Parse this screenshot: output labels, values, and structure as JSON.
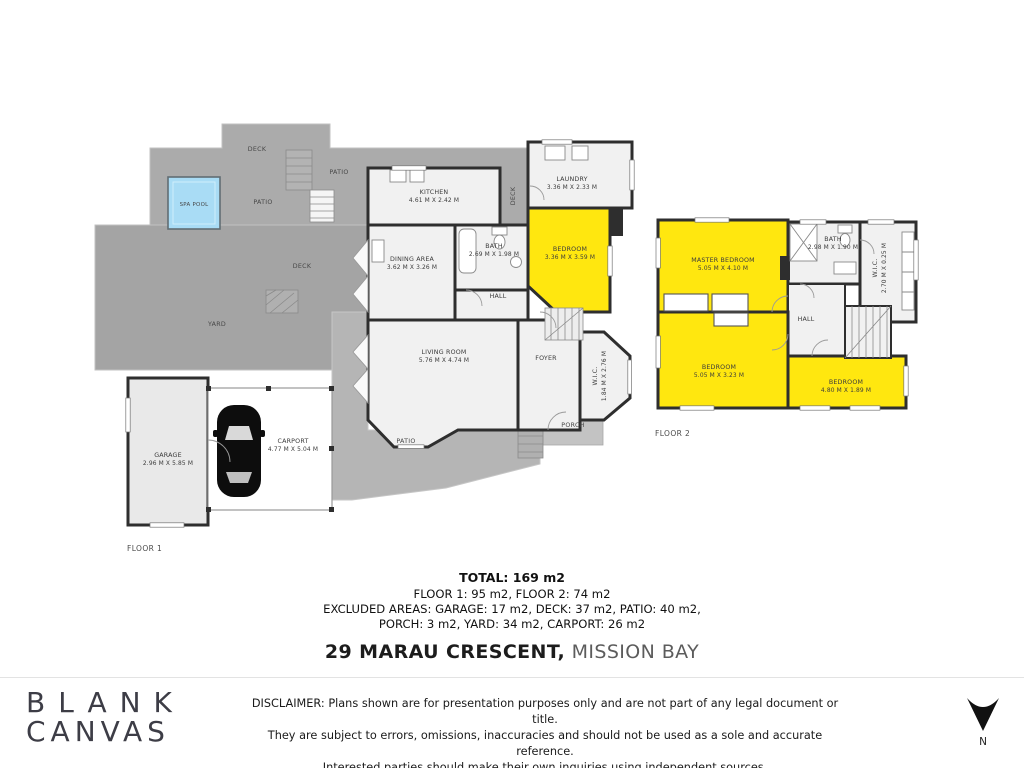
{
  "floor1": {
    "floor_label": "FLOOR 1",
    "outdoor": {
      "deck_top": "DECK",
      "patio_top": "PATIO",
      "spa_pool": "SPA POOL",
      "patio_mid": "PATIO",
      "deck_mid": "DECK",
      "yard": "YARD",
      "deck_strip": "DECK",
      "patio_bottom": "PATIO",
      "porch": "PORCH"
    },
    "rooms": {
      "kitchen": {
        "name": "KITCHEN",
        "dims": "4.61 M X 2.42 M"
      },
      "laundry": {
        "name": "LAUNDRY",
        "dims": "3.36 M X 2.33 M"
      },
      "bath": {
        "name": "BATH",
        "dims": "2.69 M X 1.98 M"
      },
      "bedroom": {
        "name": "BEDROOM",
        "dims": "3.36 M X 3.59 M"
      },
      "dining": {
        "name": "DINING AREA",
        "dims": "3.62 M X 3.26 M"
      },
      "living": {
        "name": "LIVING ROOM",
        "dims": "5.76 M X 4.74 M"
      },
      "hall": {
        "name": "HALL"
      },
      "foyer": {
        "name": "FOYER"
      },
      "wic": {
        "name": "W.I.C.",
        "dims": "1.84 M X 2.76 M"
      },
      "garage": {
        "name": "GARAGE",
        "dims": "2.96 M X 5.85 M"
      },
      "carport": {
        "name": "CARPORT",
        "dims": "4.77 M X 5.04 M"
      }
    }
  },
  "floor2": {
    "floor_label": "FLOOR 2",
    "rooms": {
      "master": {
        "name": "MASTER BEDROOM",
        "dims": "5.05 M X 4.10 M"
      },
      "bath": {
        "name": "BATH",
        "dims": "2.98 M X 1.90 M"
      },
      "wic": {
        "name": "W.I.C.",
        "dims": "2.70 M X 0.25 M"
      },
      "hall": {
        "name": "HALL"
      },
      "bedroom2": {
        "name": "BEDROOM",
        "dims": "5.05 M X 3.23 M"
      },
      "bedroom3": {
        "name": "BEDROOM",
        "dims": "4.80 M X 1.89 M"
      }
    }
  },
  "summary": {
    "total": "TOTAL: 169 m2",
    "line2": "FLOOR 1: 95 m2, FLOOR 2: 74 m2",
    "line3": "EXCLUDED AREAS: GARAGE: 17 m2, DECK: 37 m2, PATIO: 40 m2,",
    "line4": "PORCH: 3 m2, YARD: 34 m2, CARPORT: 26 m2"
  },
  "address": {
    "street": "29 MARAU CRESCENT,",
    "suburb": "MISSION BAY"
  },
  "footer": {
    "logo_top": "BLANK",
    "logo_bottom": "CANVAS",
    "disclaimer_line1": "DISCLAIMER: Plans shown are for presentation purposes only and are not part of any legal document or title.",
    "disclaimer_line2": "They are subject to errors, omissions, inaccuracies and should not be used as a sole and accurate reference.",
    "disclaimer_line3": "Interested parties should make their own inquiries using independent sources.",
    "north": "N"
  },
  "colors": {
    "highlight_yellow": "#FFE70F",
    "pool_blue": "#A9DCF5",
    "outdoor_gray": "#A9A9A9",
    "wall": "#2E2E2E"
  }
}
